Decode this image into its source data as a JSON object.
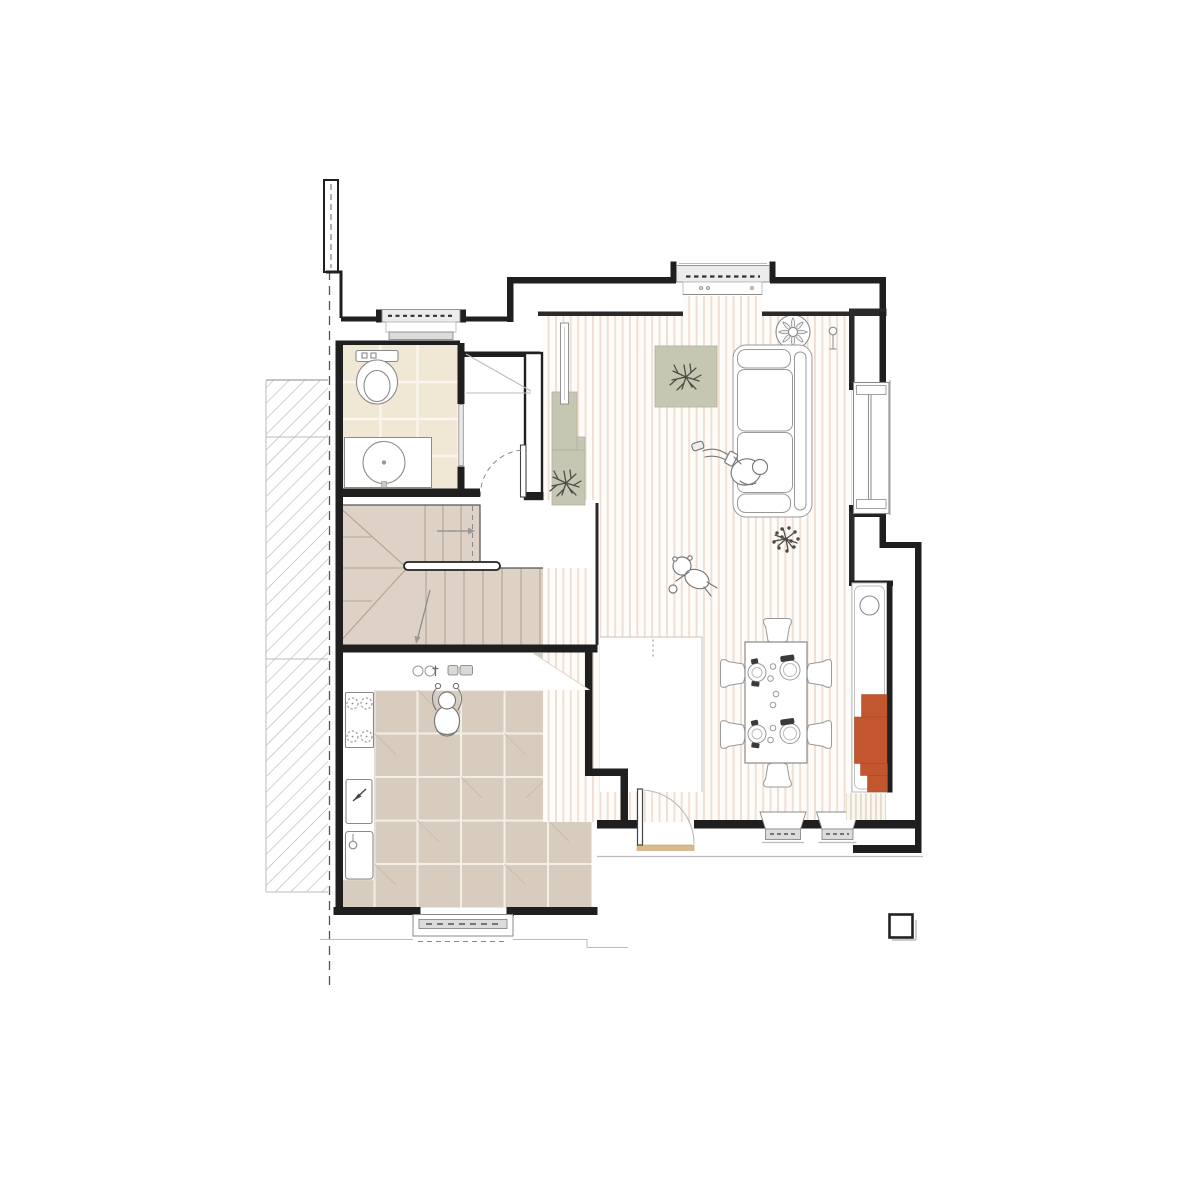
{
  "document": {
    "type": "architectural-floor-plan",
    "view": "top-down ground floor plan, no text labels rendered",
    "background": "#ffffff"
  },
  "palette": {
    "wall": "#1f1f1f",
    "line_dark": "#555555",
    "line": "#8a8a8a",
    "line_light": "#bbbbbb",
    "floor_base": "#fefcf9",
    "floor_stripe": "#f1ded2",
    "kitchen_tile": "#d8ccbf",
    "kitchen_grout": "#f3efe7",
    "tile_accent": "#cabdaf",
    "bath_tile": "#f1e7d5",
    "bath_grout": "#faf6ed",
    "stair_fill": "#ddd2c5",
    "stair_line": "#b0a595",
    "sage": "#c5c7b2",
    "sage_edge": "#b0b29c",
    "orange": "#c2572f",
    "orange_edge": "#a8481f",
    "hatch": "#b8b4ac",
    "threshold": "#d9ba8c",
    "plant": "#4c4c44",
    "mat_stripe": "#e6dbc9",
    "window_fill": "#ececea",
    "frame_fill": "#dcdcda"
  },
  "rooms": [
    {
      "name": "living-dining-room",
      "floor": "wood-plank-stripes"
    },
    {
      "name": "kitchen",
      "floor": "stone-tile-grid"
    },
    {
      "name": "bathroom",
      "floor": "ceramic-tile-grid"
    },
    {
      "name": "hallway-with-closet",
      "floor": "plain"
    },
    {
      "name": "staircase-with-winders",
      "floor": "stair-treads"
    }
  ],
  "furniture_icons": [
    "sofa-icon",
    "area-rug-icon",
    "tv-sideboard-icon",
    "ceiling-fan-icon",
    "floor-lamp-icon",
    "dining-table-icon",
    "dining-chair-icon",
    "place-setting-icon",
    "niche-counter-icon",
    "niche-sink-icon",
    "orange-cabinet-icon",
    "striped-mat-icon",
    "toilet-icon",
    "washbasin-icon",
    "stove-icon",
    "kitchen-sink-icon",
    "cutting-board-icon",
    "handrail-icon",
    "door-swing-icon",
    "window-icon",
    "plant-icon",
    "patio-post-icon"
  ],
  "figure_icons": [
    "person-reading-on-sofa-icon",
    "person-cooking-icon",
    "toddler-playing-icon"
  ],
  "counts": {
    "dining_chairs": 6,
    "place_settings": 4,
    "plants": 3,
    "people_figures": 3,
    "windows": 6,
    "door_swings": 3,
    "orange_cabinet_steps": 4
  },
  "site": {
    "neighbor_hatch_strip": "diagonal hatch, left side",
    "property_line": "vertical dashed line, left side"
  }
}
